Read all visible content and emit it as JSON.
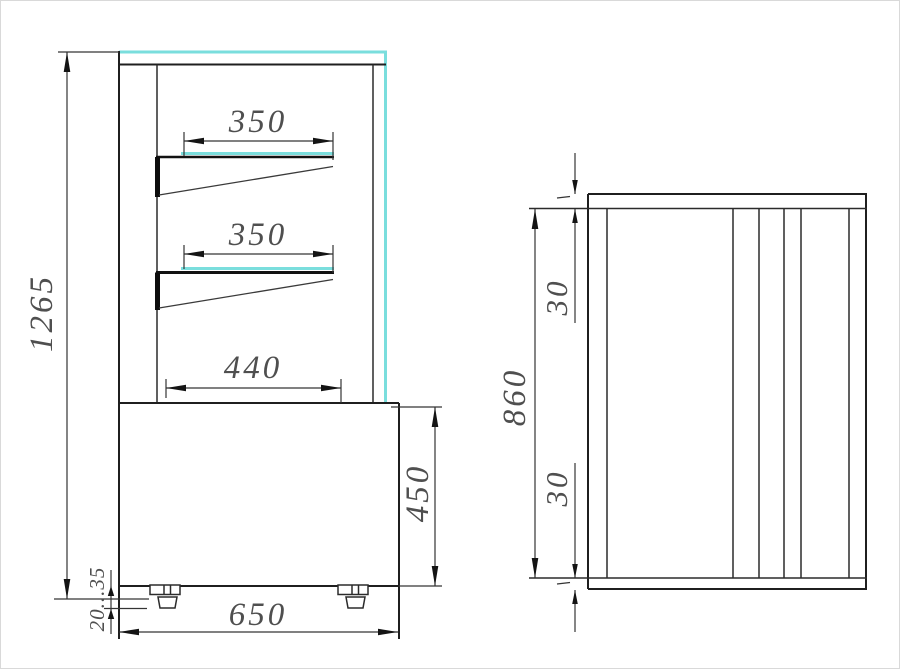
{
  "drawing": {
    "type": "technical-dimension-drawing",
    "views": {
      "left": "front view of refrigerated display case",
      "right": "side view"
    },
    "front_view": {
      "height_total": "1265",
      "upper_shelf_width": "350",
      "middle_shelf_width": "350",
      "lower_shelf_width": "440",
      "base_height": "450",
      "overall_width": "650",
      "foot_adjust_range": "20...35"
    },
    "side_view": {
      "inner_height": "860",
      "top_panel": "30",
      "bottom_panel": "30"
    },
    "colors": {
      "line": "#1f1f1f",
      "dimension_line": "#343434",
      "text": "#4f4f4f",
      "glass_highlight_cyan": "#7adedd",
      "background": "#ffffff"
    }
  }
}
